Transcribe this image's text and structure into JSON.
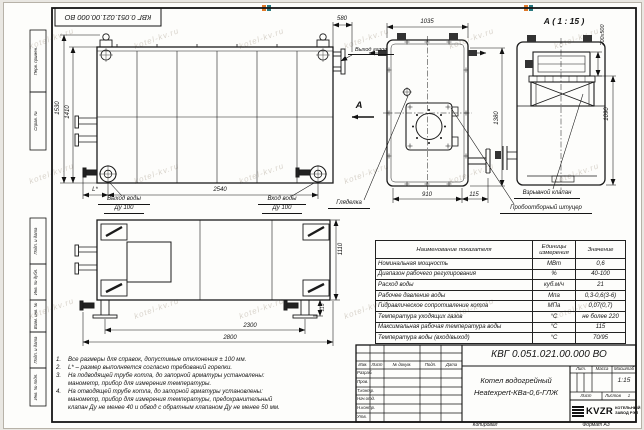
{
  "sheet": {
    "doc_number_top": "КВГ 0.051.021.00.000 ВО",
    "copied_label": "Копировал",
    "format_label": "Формат А3"
  },
  "frame": {
    "left_labels": [
      "Перв. примен.",
      "Справ. №",
      "Подп. и дата",
      "Инв. № дубл.",
      "Взам. инв. №",
      "Подп. и дата",
      "Инв. № подл."
    ]
  },
  "watermark": {
    "text": "kotel-kv.ru",
    "logo_colors": [
      "#e07a2a",
      "#2a7a80"
    ]
  },
  "views": {
    "side": {
      "dims": {
        "outer_height": "1530",
        "inner_height": "1410",
        "length": "2540",
        "l_star": "L*",
        "gas_offset": "580"
      },
      "water_out_line1": "Выход воды",
      "water_out_line2": "Ду 100",
      "water_in_line1": "Вход воды",
      "water_in_line2": "Ду 100",
      "gas_out_label": "Выход газов",
      "section_letter": "А"
    },
    "front": {
      "dims": {
        "top_width": "1035",
        "bottom_width": "910",
        "fitting_offset": "115",
        "height": "1380"
      },
      "sight_label": "Гляделка",
      "sampler_label": "Пробоотборный штуцер"
    },
    "detail": {
      "title": "А ( 1 : 15 )",
      "dims": {
        "duct": "200x500",
        "height": "1090"
      },
      "explosion_label": "Взрывной клапан"
    },
    "plan": {
      "dims": {
        "feet_span": "2300",
        "overall_length": "2800",
        "width": "1110",
        "support": "115"
      }
    }
  },
  "notes": [
    {
      "num": "1.",
      "text": "Все размеры для справок, допустимые отклонения ± 100 мм."
    },
    {
      "num": "2.",
      "text": "L* – размер выполняется согласно требований горелки."
    },
    {
      "num": "3.",
      "text": "На подводящей трубе котла, до запорной арматуры установлены:\nманометр, прибор для измерения температуры."
    },
    {
      "num": "4.",
      "text": "На отводящей трубе котла, до запорной арматуры установлены:\nманометр, прибор для измерения температуры, предохранительный\nклапан Ду не менее 40 и обвод с обратным клапаном Ду не менее 50 мм."
    }
  ],
  "spec_table": {
    "headers": [
      "Наименование показателя",
      "Единицы\nизмерения",
      "Значение"
    ],
    "rows": [
      [
        "Номинальная мощность",
        "МВт",
        "0,6"
      ],
      [
        "Диапазон рабочего регулирования",
        "%",
        "40-100"
      ],
      [
        "Расход воды",
        "куб.м/ч",
        "21"
      ],
      [
        "Рабочее давление воды",
        "Мпа",
        "0,3-0,6(3-6)"
      ],
      [
        "Гидравлическое сопротивление котла",
        "МПа",
        "0,07(0,7)"
      ],
      [
        "Температура уходящих газов",
        "°С",
        "не более 220"
      ],
      [
        "Максимальная рабочая температура воды",
        "°С",
        "115"
      ],
      [
        "Температура воды (вход/выход)",
        "°С",
        "70/95"
      ]
    ]
  },
  "title_block": {
    "doc_number": "КВГ 0.051.021.00.000 ВО",
    "product_line1": "Котел водогрейный",
    "product_line2": "Heatexpert-КВа-0,6-ГЛЖ",
    "col_headers": [
      "Изм.",
      "Лист",
      "№ докум.",
      "Подп.",
      "Дата"
    ],
    "roles": [
      "Разраб.",
      "Пров.",
      "Т.контр.",
      "Нач.отд.",
      "Н.контр.",
      "Утв."
    ],
    "lit_label": "Лит.",
    "mass_label": "Масса",
    "scale_label": "Масштаб",
    "scale_value": "1:15",
    "sheet_label": "Лист",
    "sheets_label": "Листов",
    "sheets_value": "1",
    "logo_text": "KVZR",
    "company_line1": "КОТЕЛЬНЫЙ",
    "company_line2": "ЗАВОД РЭП"
  }
}
